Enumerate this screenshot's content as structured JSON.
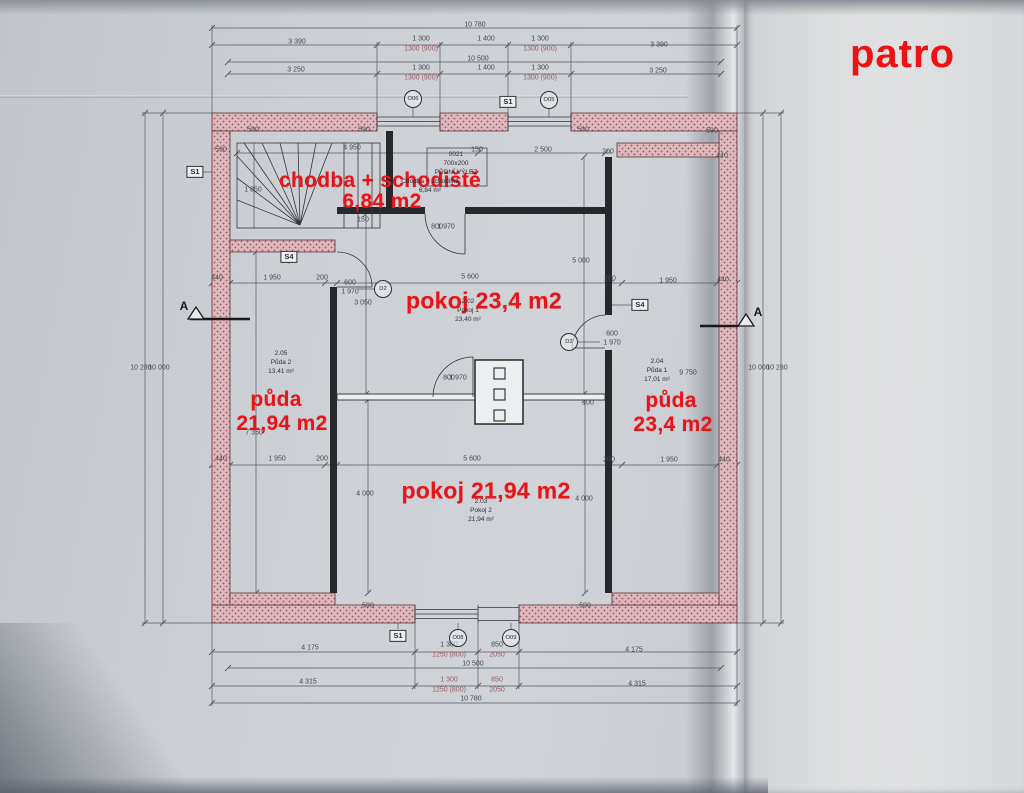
{
  "sheet_title": "patro",
  "plan": {
    "red_labels": [
      {
        "name": "label-chodba-red",
        "text": "chodba + schodiště",
        "x": 380,
        "y": 181,
        "fs": 21
      },
      {
        "name": "label-chodba-area-red",
        "text": "6,84 m2",
        "x": 382,
        "y": 202,
        "fs": 21
      },
      {
        "name": "label-pokoj1-red",
        "text": "pokoj 23,4 m2",
        "x": 484,
        "y": 301,
        "fs": 23
      },
      {
        "name": "label-puda-left-red",
        "text": "půda",
        "x": 276,
        "y": 400,
        "fs": 21
      },
      {
        "name": "label-puda-left-area-red",
        "text": "21,94 m2",
        "x": 282,
        "y": 424,
        "fs": 21
      },
      {
        "name": "label-puda-right-red",
        "text": "půda",
        "x": 671,
        "y": 401,
        "fs": 21
      },
      {
        "name": "label-puda-right-area-red",
        "text": "23,4 m2",
        "x": 673,
        "y": 425,
        "fs": 21
      },
      {
        "name": "label-pokoj2-red",
        "text": "pokoj 21,94 m2",
        "x": 486,
        "y": 491,
        "fs": 23
      }
    ],
    "room_labels": [
      {
        "name": "room-chodba",
        "x": 430,
        "y": 187,
        "lines": [
          "Chodba + schodiště",
          "6,84 m²"
        ]
      },
      {
        "name": "room-vylez",
        "x": 456,
        "y": 164,
        "lines": [
          "0021",
          "700x200",
          "PŮDNÍ VÝLEZ"
        ]
      },
      {
        "name": "room-pokoj1",
        "x": 468,
        "y": 311,
        "lines": [
          "2.02",
          "Pokoj 1",
          "23,40 m²"
        ]
      },
      {
        "name": "room-puda2",
        "x": 281,
        "y": 363,
        "lines": [
          "2.05",
          "Půda 2",
          "13,41 m²"
        ]
      },
      {
        "name": "room-puda1",
        "x": 657,
        "y": 371,
        "lines": [
          "2.04",
          "Půda 1",
          "17,01 m²"
        ]
      },
      {
        "name": "room-pokoj2",
        "x": 481,
        "y": 511,
        "lines": [
          "2.03",
          "Pokoj 2",
          "21,94 m²"
        ]
      }
    ],
    "dims": [
      {
        "t": "10 780",
        "x": 475,
        "y": 25
      },
      {
        "t": "3 390",
        "x": 297,
        "y": 42
      },
      {
        "t": "1 300",
        "x": 421,
        "y": 39
      },
      {
        "t": "1300 (900)",
        "x": 421,
        "y": 49,
        "p": 1
      },
      {
        "t": "1 400",
        "x": 486,
        "y": 39
      },
      {
        "t": "1 300",
        "x": 540,
        "y": 39
      },
      {
        "t": "1300 (900)",
        "x": 540,
        "y": 49,
        "p": 1
      },
      {
        "t": "3 390",
        "x": 659,
        "y": 45
      },
      {
        "t": "10 500",
        "x": 478,
        "y": 59
      },
      {
        "t": "3 250",
        "x": 296,
        "y": 70
      },
      {
        "t": "1 300",
        "x": 421,
        "y": 68
      },
      {
        "t": "1300 (900)",
        "x": 421,
        "y": 78,
        "p": 1
      },
      {
        "t": "1 400",
        "x": 486,
        "y": 68
      },
      {
        "t": "1 300",
        "x": 540,
        "y": 68
      },
      {
        "t": "1300 (900)",
        "x": 540,
        "y": 78,
        "p": 1
      },
      {
        "t": "3 250",
        "x": 658,
        "y": 71
      },
      {
        "t": "4 175",
        "x": 310,
        "y": 648
      },
      {
        "t": "1 300",
        "x": 449,
        "y": 645
      },
      {
        "t": "1250 (800)",
        "x": 449,
        "y": 655,
        "p": 1
      },
      {
        "t": "850",
        "x": 497,
        "y": 645
      },
      {
        "t": "2050",
        "x": 497,
        "y": 655,
        "p": 1
      },
      {
        "t": "4 175",
        "x": 634,
        "y": 650
      },
      {
        "t": "10 500",
        "x": 473,
        "y": 664
      },
      {
        "t": "4 315",
        "x": 308,
        "y": 682
      },
      {
        "t": "1 300",
        "x": 449,
        "y": 680,
        "p": 1
      },
      {
        "t": "1250 (800)",
        "x": 449,
        "y": 690,
        "p": 1
      },
      {
        "t": "850",
        "x": 497,
        "y": 680,
        "p": 1
      },
      {
        "t": "2050",
        "x": 497,
        "y": 690,
        "p": 1
      },
      {
        "t": "4 315",
        "x": 637,
        "y": 684
      },
      {
        "t": "10 780",
        "x": 471,
        "y": 699
      },
      {
        "t": "10 280",
        "x": 141,
        "y": 368,
        "r": 1
      },
      {
        "t": "10 000",
        "x": 159,
        "y": 368,
        "r": 1
      },
      {
        "t": "10 000",
        "x": 759,
        "y": 368,
        "r": 1
      },
      {
        "t": "10 280",
        "x": 777,
        "y": 368,
        "r": 1
      },
      {
        "t": "590",
        "x": 221,
        "y": 150
      },
      {
        "t": "440",
        "x": 217,
        "y": 278
      },
      {
        "t": "1 950",
        "x": 272,
        "y": 278
      },
      {
        "t": "200",
        "x": 322,
        "y": 278
      },
      {
        "t": "600",
        "x": 350,
        "y": 283
      },
      {
        "t": "1 970",
        "x": 350,
        "y": 292
      },
      {
        "t": "200",
        "x": 610,
        "y": 279
      },
      {
        "t": "1 950",
        "x": 668,
        "y": 281
      },
      {
        "t": "440",
        "x": 723,
        "y": 280
      },
      {
        "t": "440",
        "x": 722,
        "y": 156
      },
      {
        "t": "600",
        "x": 612,
        "y": 334
      },
      {
        "t": "1 970",
        "x": 612,
        "y": 343
      },
      {
        "t": "440",
        "x": 221,
        "y": 459
      },
      {
        "t": "1 950",
        "x": 277,
        "y": 459
      },
      {
        "t": "200",
        "x": 322,
        "y": 459
      },
      {
        "t": "5 600",
        "x": 472,
        "y": 459
      },
      {
        "t": "200",
        "x": 609,
        "y": 460
      },
      {
        "t": "1 950",
        "x": 669,
        "y": 460
      },
      {
        "t": "440",
        "x": 724,
        "y": 460
      },
      {
        "t": "5 600",
        "x": 470,
        "y": 277
      },
      {
        "t": "4 950",
        "x": 352,
        "y": 148
      },
      {
        "t": "2 500",
        "x": 543,
        "y": 150
      },
      {
        "t": "200",
        "x": 608,
        "y": 152
      },
      {
        "t": "150",
        "x": 477,
        "y": 150
      },
      {
        "t": "590",
        "x": 253,
        "y": 130,
        "r": 1
      },
      {
        "t": "590",
        "x": 364,
        "y": 130,
        "r": 1
      },
      {
        "t": "590",
        "x": 583,
        "y": 130,
        "r": 1
      },
      {
        "t": "590",
        "x": 712,
        "y": 131,
        "r": 1
      },
      {
        "t": "590",
        "x": 368,
        "y": 606,
        "r": 1
      },
      {
        "t": "590",
        "x": 585,
        "y": 606,
        "r": 1
      },
      {
        "t": "150",
        "x": 363,
        "y": 220,
        "r": 1
      },
      {
        "t": "1 850",
        "x": 253,
        "y": 190,
        "r": 1
      },
      {
        "t": "3 050",
        "x": 363,
        "y": 303,
        "r": 1
      },
      {
        "t": "5 000",
        "x": 581,
        "y": 261,
        "r": 1
      },
      {
        "t": "800",
        "x": 437,
        "y": 227,
        "r": 1
      },
      {
        "t": "1 970",
        "x": 446,
        "y": 227,
        "r": 1
      },
      {
        "t": "800",
        "x": 449,
        "y": 378,
        "r": 1
      },
      {
        "t": "1 970",
        "x": 458,
        "y": 378,
        "r": 1
      },
      {
        "t": "100",
        "x": 588,
        "y": 403,
        "r": 1
      },
      {
        "t": "4 000",
        "x": 365,
        "y": 494,
        "r": 1
      },
      {
        "t": "4 000",
        "x": 584,
        "y": 499,
        "r": 1
      },
      {
        "t": "7 350",
        "x": 254,
        "y": 433,
        "r": 1
      },
      {
        "t": "9 750",
        "x": 688,
        "y": 373,
        "r": 1
      }
    ],
    "markers": [
      {
        "shape": "box",
        "label": "S1",
        "x": 195,
        "y": 172,
        "name": "marker-s1-left"
      },
      {
        "shape": "box",
        "label": "S1",
        "x": 508,
        "y": 102,
        "name": "marker-s1-top"
      },
      {
        "shape": "box",
        "label": "S1",
        "x": 398,
        "y": 636,
        "name": "marker-s1-bottom"
      },
      {
        "shape": "box",
        "label": "S4",
        "x": 289,
        "y": 257,
        "name": "marker-s4-left"
      },
      {
        "shape": "box",
        "label": "S4",
        "x": 640,
        "y": 305,
        "name": "marker-s4-right"
      },
      {
        "shape": "circle",
        "label": "O06",
        "x": 413,
        "y": 99,
        "name": "marker-window-o06"
      },
      {
        "shape": "circle",
        "label": "O05",
        "x": 549,
        "y": 100,
        "name": "marker-window-o05"
      },
      {
        "shape": "circle",
        "label": "O08",
        "x": 458,
        "y": 638,
        "name": "marker-window-o08"
      },
      {
        "shape": "circle",
        "label": "O09",
        "x": 511,
        "y": 638,
        "name": "marker-door-o09"
      },
      {
        "shape": "circle",
        "label": "D2",
        "x": 383,
        "y": 289,
        "name": "marker-door-d2-left"
      },
      {
        "shape": "circle",
        "label": "D2",
        "x": 569,
        "y": 342,
        "name": "marker-door-d2-right"
      }
    ],
    "section_labels": [
      {
        "label": "A",
        "x": 184,
        "y": 306,
        "name": "section-a-left"
      },
      {
        "label": "A",
        "x": 758,
        "y": 312,
        "name": "section-a-right"
      }
    ]
  }
}
